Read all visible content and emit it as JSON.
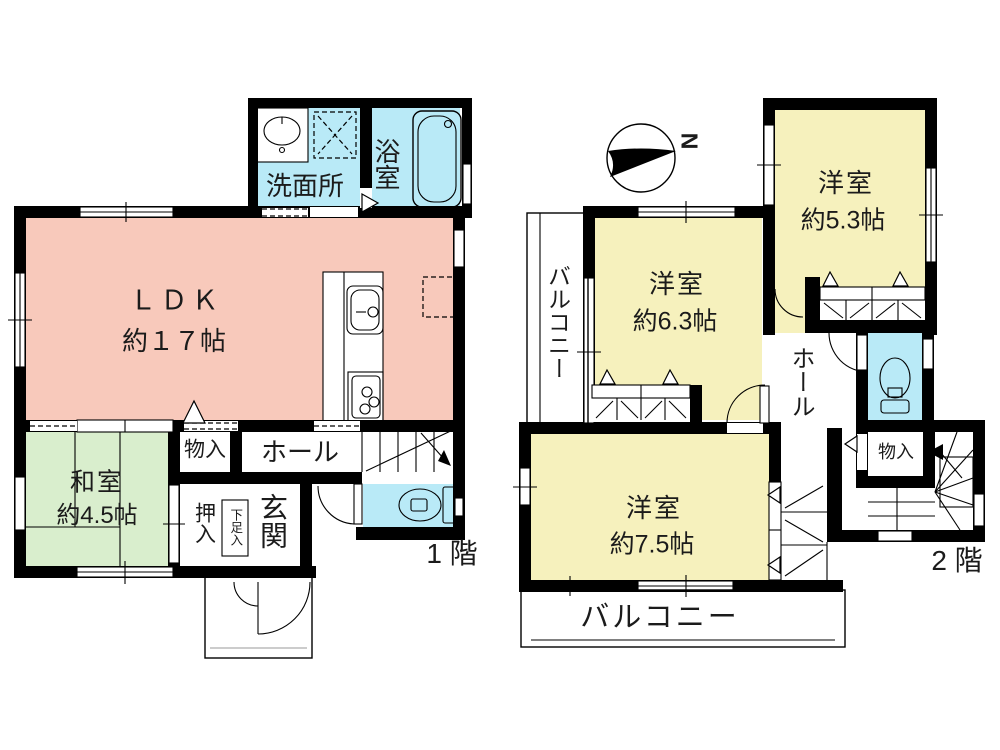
{
  "colors": {
    "wall": "#000000",
    "ldk": "#f8c9bb",
    "tatami": "#d9eecd",
    "western": "#f6f1bd",
    "wet": "#b9eaf7"
  },
  "floor1": {
    "floor_label": "1 階",
    "ldk_name": "ＬＤＫ",
    "ldk_size": "約１７帖",
    "washitsu_name": "和室",
    "washitsu_size": "約4.5帖",
    "senmenjo": "洗面所",
    "yokushitsu": "浴室",
    "monoire": "物入",
    "hall": "ホール",
    "oshiire": "押入",
    "gesokuire": "下足入",
    "genkan": "玄関"
  },
  "floor2": {
    "floor_label": "2 階",
    "compass": "N",
    "room53_name": "洋室",
    "room53_size": "約5.3帖",
    "room63_name": "洋室",
    "room63_size": "約6.3帖",
    "room75_name": "洋室",
    "room75_size": "約7.5帖",
    "balcony_side": "バルコニー",
    "balcony_south": "バルコニー",
    "hall": "ホール",
    "monoire": "物入"
  }
}
